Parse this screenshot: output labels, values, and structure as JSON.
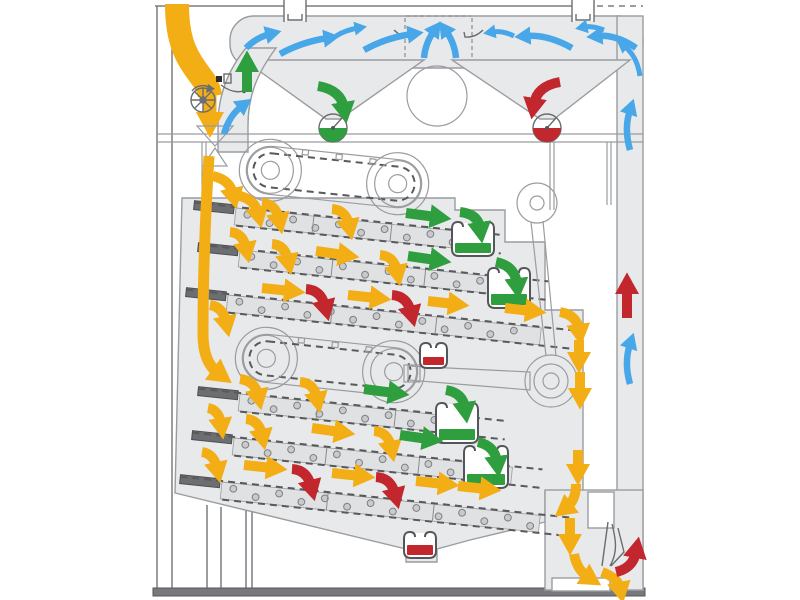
{
  "canvas": {
    "width": 800,
    "height": 600,
    "background": "#ffffff"
  },
  "colors": {
    "body": "#e8e9eb",
    "tray": "#e0e1e3",
    "stroke": "#9a9c9f",
    "dark": "#6d6e71",
    "base": "#77797c",
    "product": "#f2ae14",
    "good": "#2f9e3e",
    "bad": "#c1272d",
    "air": "#47a7e8",
    "white": "#ffffff"
  },
  "flows": {
    "product": {
      "color": "#f2ae14",
      "arrow_count": 35
    },
    "accepted": {
      "color": "#2f9e3e",
      "arrow_count": 10
    },
    "rejected": {
      "color": "#c1272d",
      "arrow_count": 7
    },
    "air": {
      "color": "#47a7e8",
      "arrow_count": 14
    }
  },
  "components": {
    "names": [
      "machine-frame",
      "feed-inlet-chute",
      "feed-metering-roller",
      "feed-sensor",
      "feed-splitter",
      "aspiration-plenum",
      "air-damper",
      "air-ducts",
      "fan",
      "settling-hopper-left",
      "settling-hopper-right",
      "rotary-valve-good",
      "rotary-valve-waste",
      "upper-spreader-conveyor",
      "lower-spreader-conveyor",
      "upper-sieve-decks",
      "lower-sieve-decks",
      "collection-troughs",
      "reject-cups",
      "drive-pulley",
      "eccentric-drive",
      "air-return-channel",
      "outlet-section",
      "base-rail"
    ],
    "sieve_decks_per_shoe": 3,
    "collection_troughs_good": 4,
    "reject_cups": 3
  }
}
